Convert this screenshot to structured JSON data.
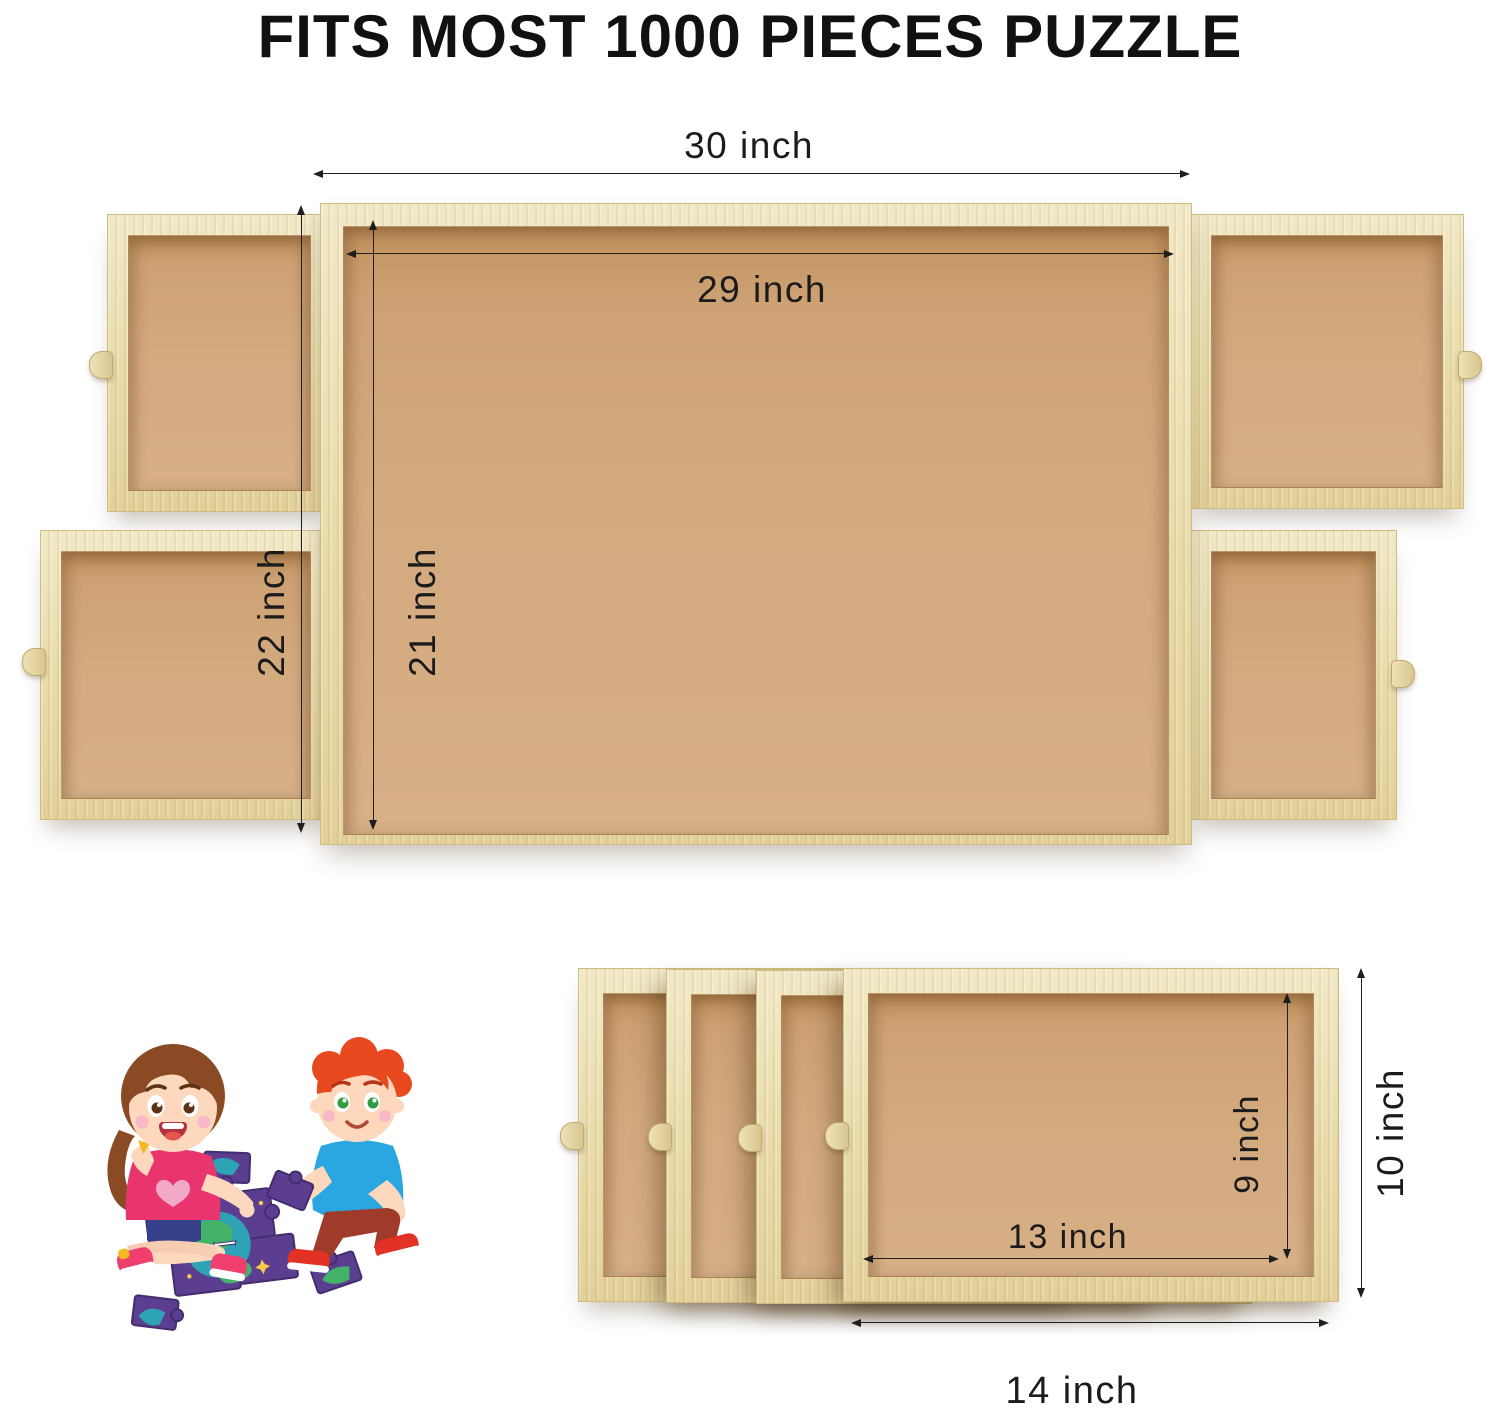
{
  "title": "FITS MOST 1000 PIECES PUZZLE",
  "board": {
    "outer_width": "30 inch",
    "inner_width": "29 inch",
    "outer_height": "22 inch",
    "inner_height": "21 inch"
  },
  "drawers": {
    "inner_width": "13 inch",
    "outer_width": "14 inch",
    "inner_height": "9 inch",
    "outer_height": "10 inch"
  },
  "colors": {
    "wood_frame": "#e9dcab",
    "tray_surface": "#d3a97e",
    "title_text": "#111111",
    "dimension_text": "#1b1b1b",
    "background": "#ffffff",
    "girl_shirt": "#e8356e",
    "girl_hair": "#8a4b24",
    "boy_shirt": "#2aa7e0",
    "boy_hair": "#e8491f",
    "puzzle_piece": "#5b3e90",
    "puzzle_earth_land": "#45b269",
    "puzzle_earth_sea": "#2ea3b5"
  }
}
